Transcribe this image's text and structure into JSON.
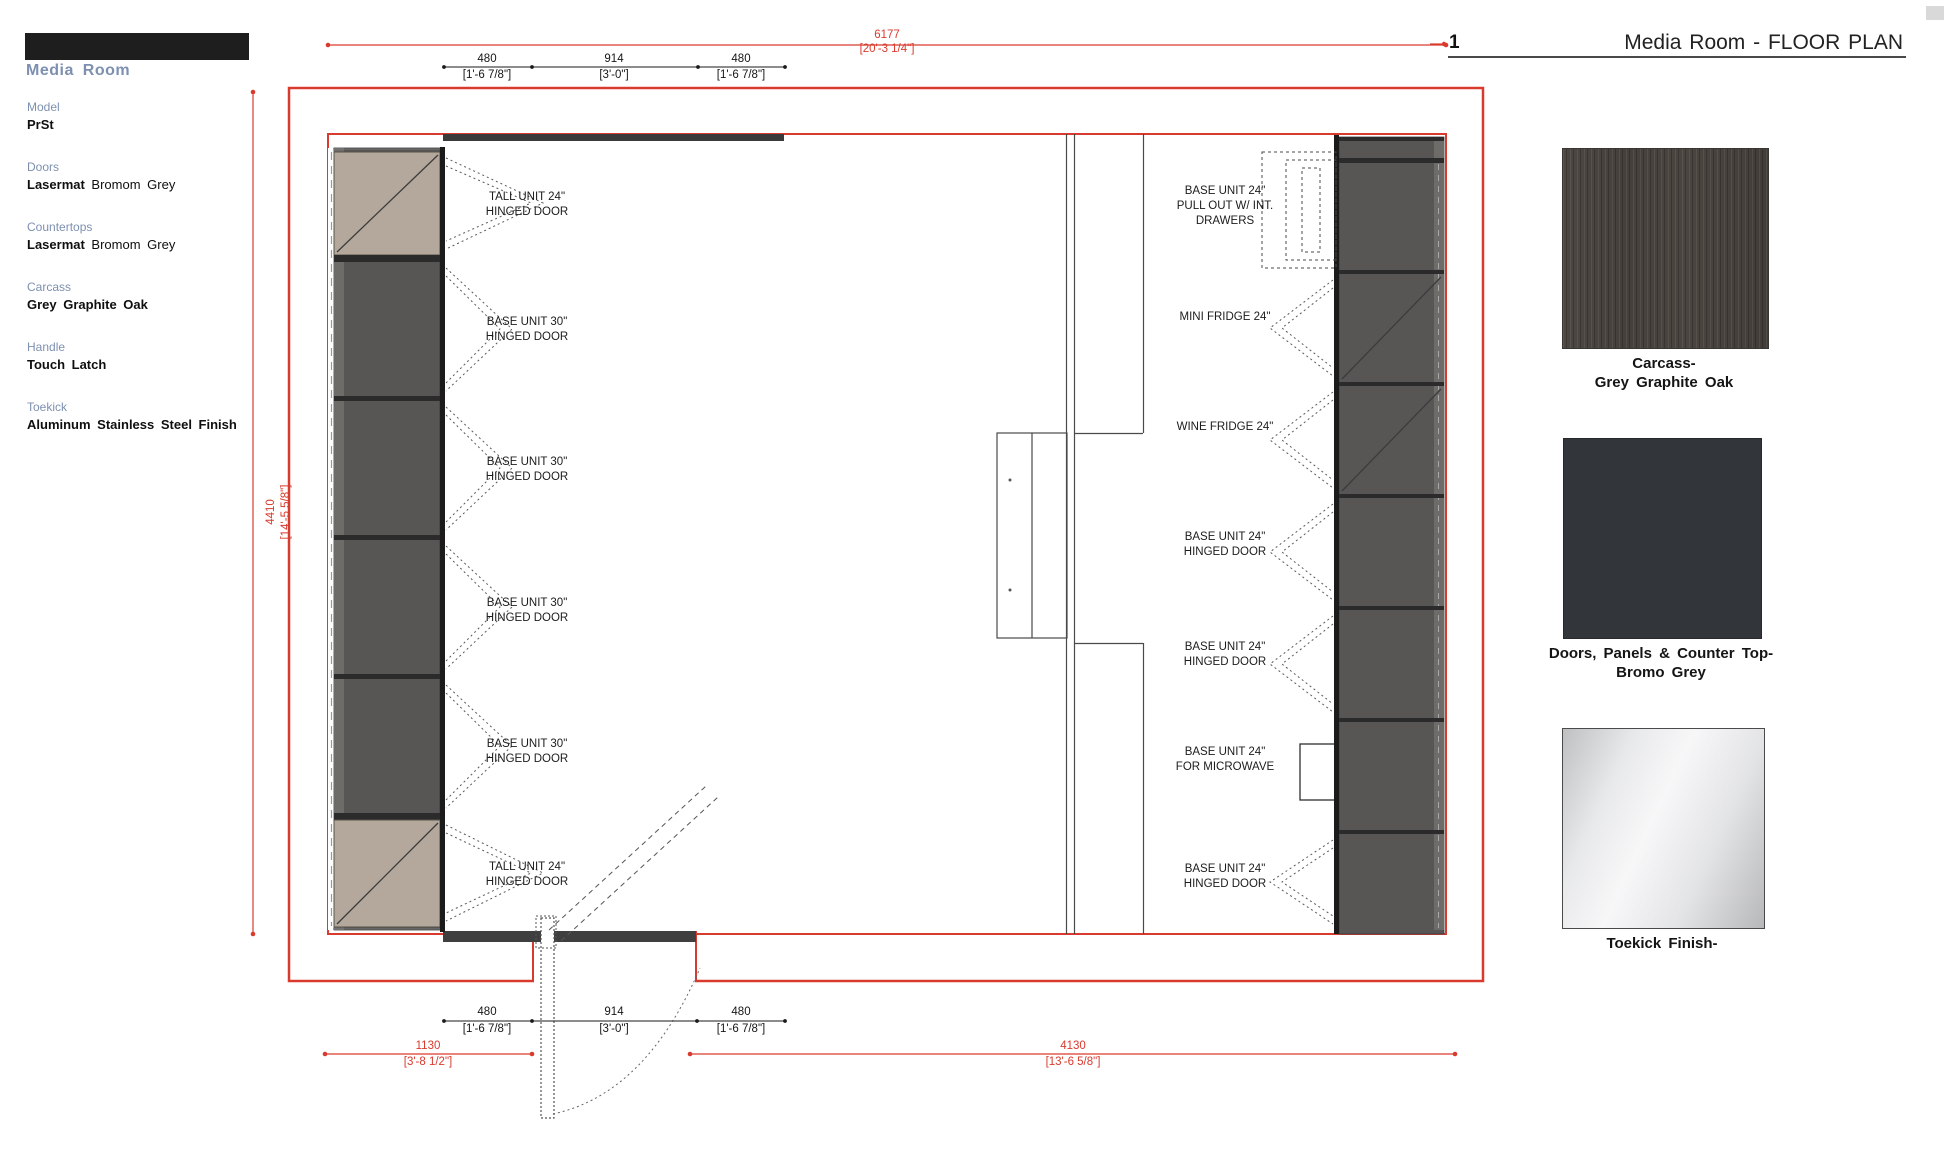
{
  "colors": {
    "red": "#d93a2e",
    "blue": "#7d90b0",
    "wall": "#c9c9c9",
    "cab": "#575655",
    "tan": "#b3a89b"
  },
  "sidebar": {
    "title": "Media Room",
    "specs": [
      {
        "label": "Model",
        "strong": "PrSt",
        "normal": ""
      },
      {
        "label": "Doors",
        "strong": "Lasermat",
        "normal": " Bromom Grey"
      },
      {
        "label": "Countertops",
        "strong": "Lasermat",
        "normal": " Bromom Grey"
      },
      {
        "label": "Carcass",
        "strong": "Grey Graphite Oak",
        "normal": ""
      },
      {
        "label": "Handle",
        "strong": "Touch Latch",
        "normal": ""
      },
      {
        "label": "Toekick",
        "strong": "Aluminum Stainless Steel Finish",
        "normal": ""
      }
    ]
  },
  "titleblock": {
    "number": "1",
    "title": "Media Room - FLOOR PLAN"
  },
  "dimensions": {
    "top_overall": {
      "mm": "6177",
      "ft": "[20'-3 1/4\"]"
    },
    "left_overall": {
      "mm": "4410",
      "ft": "[14'-5 5/8\"]"
    },
    "top_segments": [
      {
        "mm": "480",
        "ft": "[1'-6 7/8\"]"
      },
      {
        "mm": "914",
        "ft": "[3'-0\"]"
      },
      {
        "mm": "480",
        "ft": "[1'-6 7/8\"]"
      }
    ],
    "bottom_segments": [
      {
        "mm": "480",
        "ft": "[1'-6 7/8\"]"
      },
      {
        "mm": "914",
        "ft": "[3'-0\"]"
      },
      {
        "mm": "480",
        "ft": "[1'-6 7/8\"]"
      }
    ],
    "bottom_left": {
      "mm": "1130",
      "ft": "[3'-8 1/2\"]"
    },
    "bottom_right": {
      "mm": "4130",
      "ft": "[13'-6 5/8\"]"
    }
  },
  "plan": {
    "left_labels": [
      {
        "l1": "TALL UNIT 24\"",
        "l2": "HINGED DOOR"
      },
      {
        "l1": "BASE UNIT 30\"",
        "l2": "HINGED DOOR"
      },
      {
        "l1": "BASE UNIT 30\"",
        "l2": "HINGED DOOR"
      },
      {
        "l1": "BASE UNIT 30\"",
        "l2": "HINGED DOOR"
      },
      {
        "l1": "BASE UNIT 30\"",
        "l2": "HINGED DOOR"
      },
      {
        "l1": "TALL UNIT 24\"",
        "l2": "HINGED DOOR"
      }
    ],
    "right_labels": [
      {
        "l1": "BASE UNIT 24\"",
        "l2": "PULL OUT W/ INT.",
        "l3": "DRAWERS"
      },
      {
        "l1": "MINI FRIDGE 24\""
      },
      {
        "l1": "WINE FRIDGE 24\""
      },
      {
        "l1": "BASE UNIT 24\"",
        "l2": "HINGED DOOR"
      },
      {
        "l1": "BASE UNIT 24\"",
        "l2": "HINGED DOOR"
      },
      {
        "l1": "BASE UNIT 24\"",
        "l2": "FOR MICROWAVE"
      },
      {
        "l1": "BASE UNIT 24\"",
        "l2": "HINGED DOOR"
      }
    ]
  },
  "swatches": [
    {
      "line1": "Carcass-",
      "line2": "Grey Graphite Oak"
    },
    {
      "line1": "Doors, Panels & Counter Top-",
      "line2": "Bromo Grey"
    },
    {
      "line1": "Toekick Finish-",
      "line2": ""
    }
  ]
}
